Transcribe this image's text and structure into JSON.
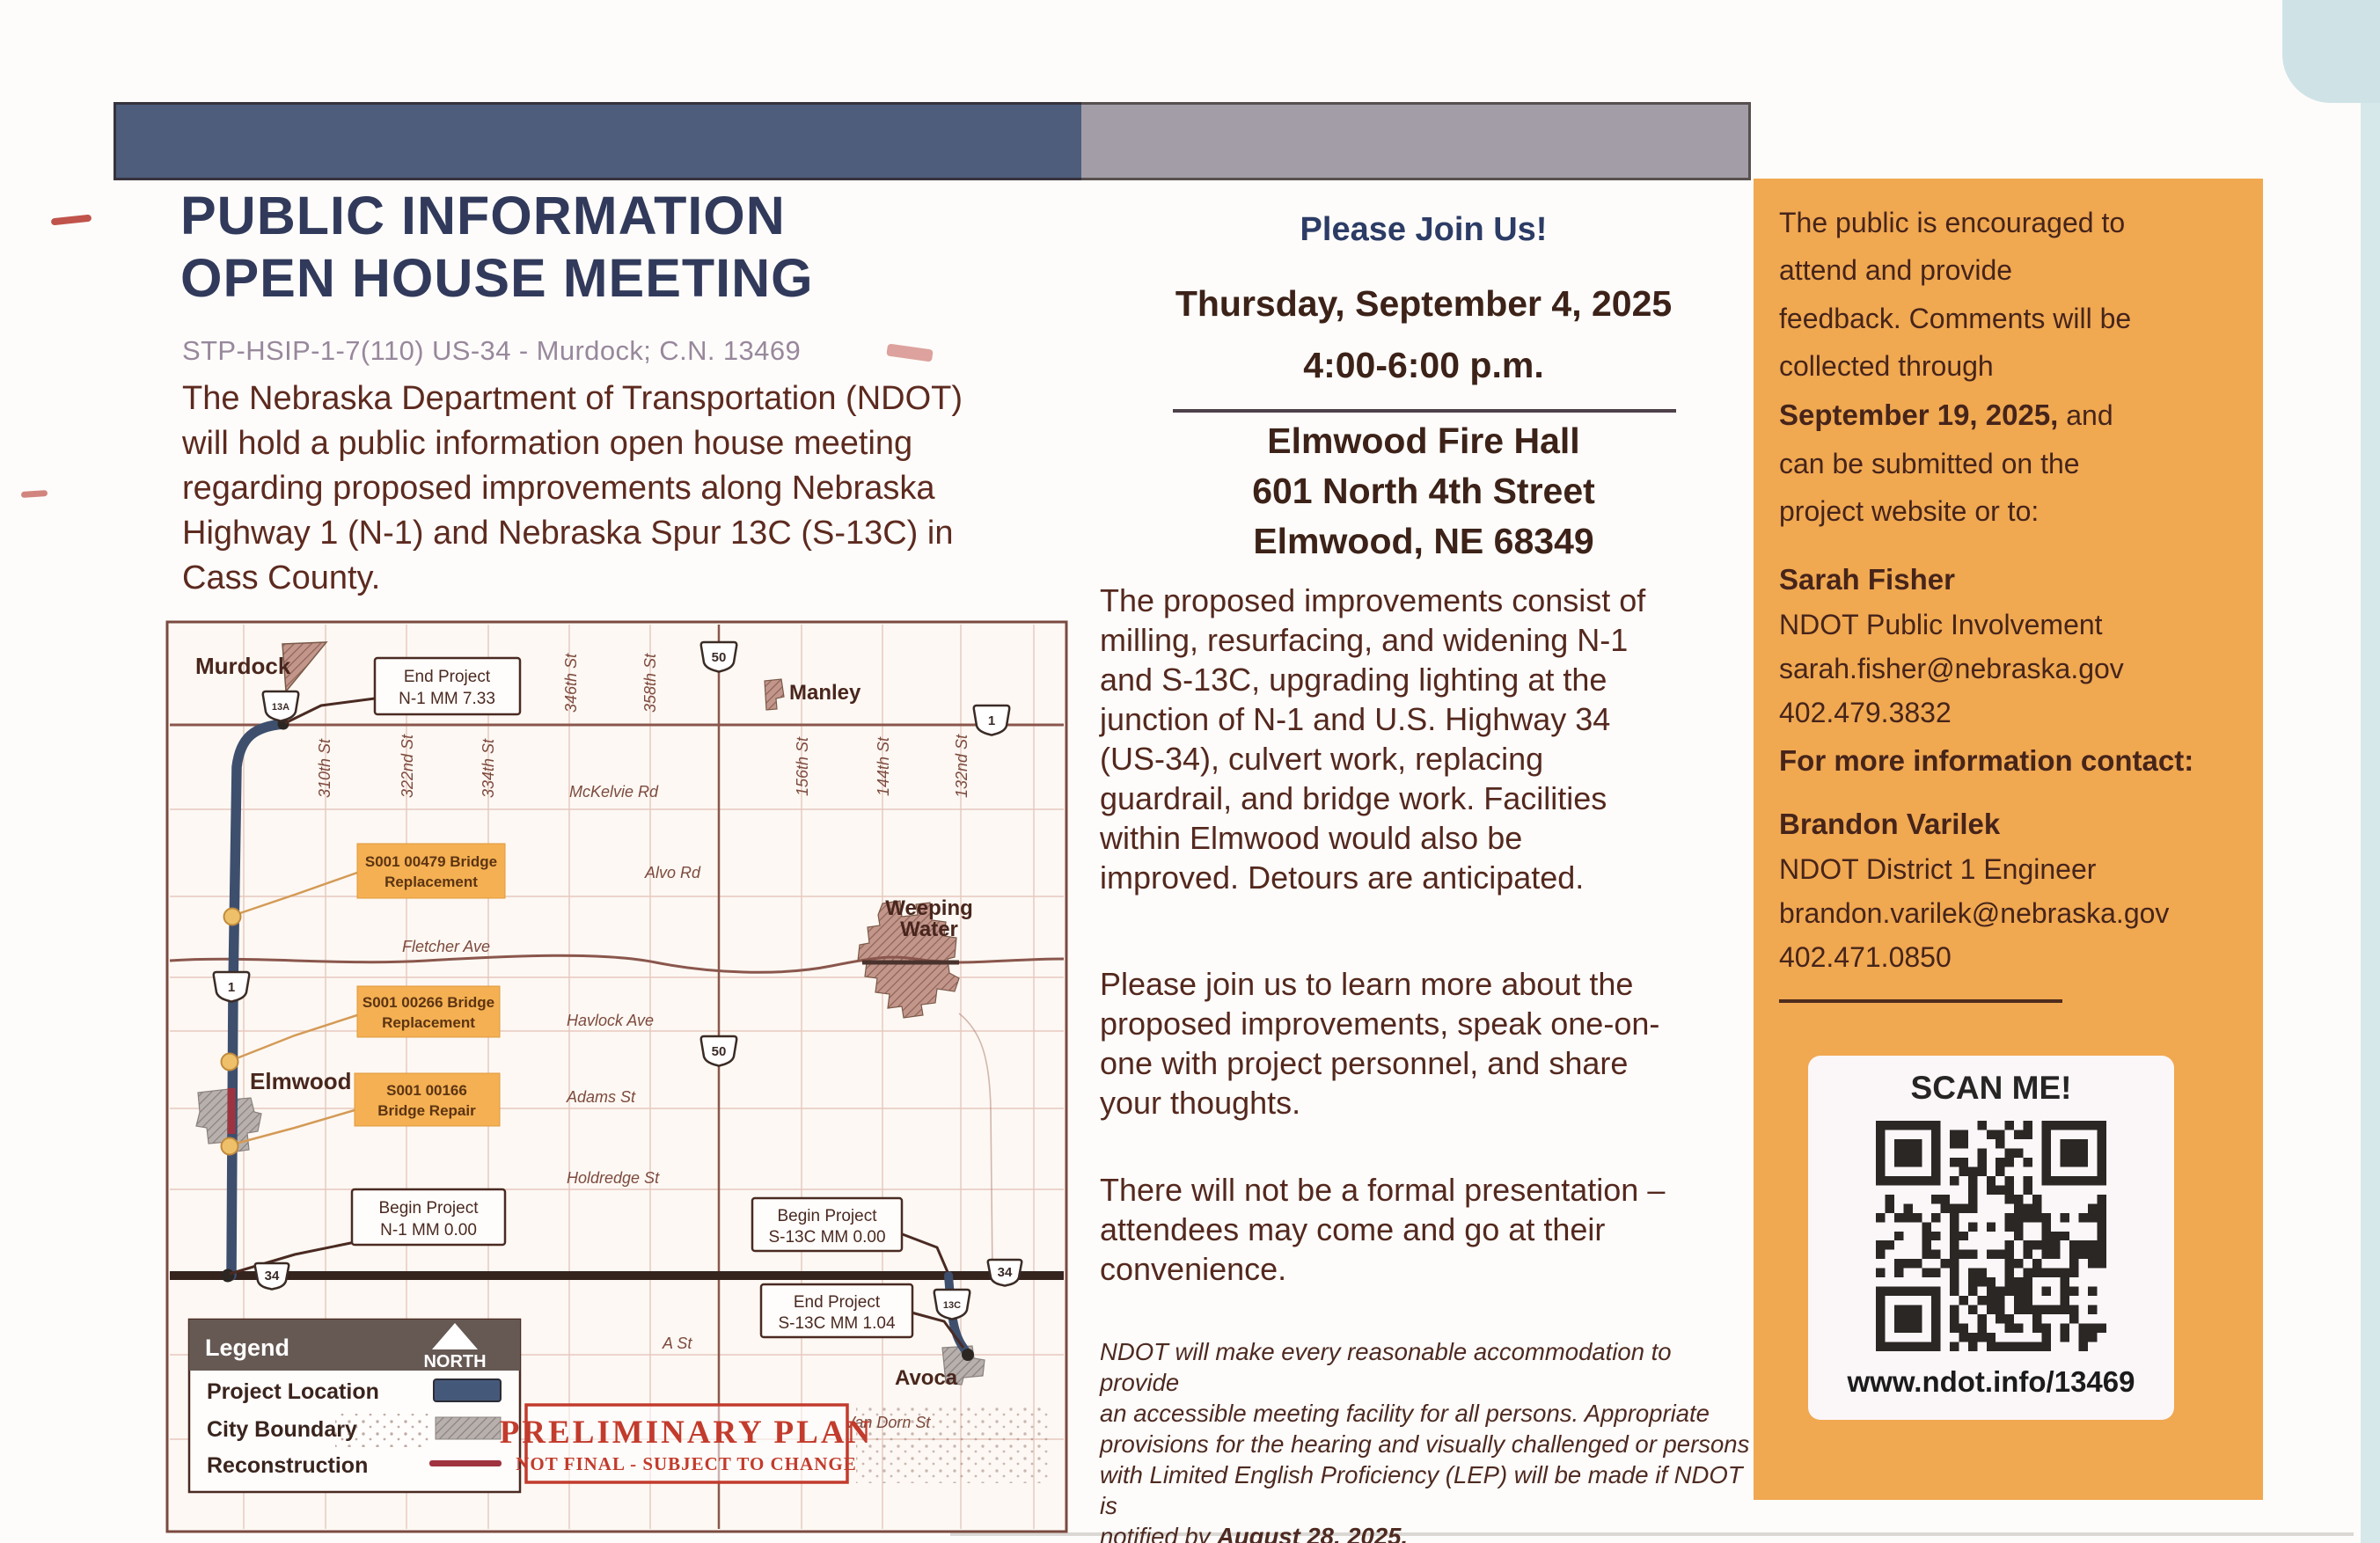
{
  "colors": {
    "bar_navy": "#4d5d7b",
    "bar_gray": "#a39da7",
    "panel_orange": "#f0a851",
    "title_navy": "#313a5b",
    "subtitle_mauve": "#98889c",
    "body_maroon": "#5d2a1f",
    "callout_orange": "#f4b052",
    "route_navy": "#3e4f6e",
    "reconstruction_red": "#9e3340",
    "stamp_red": "#c23b2c",
    "legend_header": "#665954"
  },
  "header": {
    "title_line1": "PUBLIC INFORMATION",
    "title_line2": "OPEN HOUSE MEETING",
    "subtitle": "STP-HSIP-1-7(110) US-34 - Murdock; C.N. 13469",
    "intro": "The Nebraska Department of Transportation (NDOT)\nwill hold a public information open house meeting\nregarding proposed improvements along Nebraska\nHighway 1 (N-1) and Nebraska Spur 13C (S-13C) in\nCass County."
  },
  "meeting": {
    "join": "Please Join Us!",
    "date": "Thursday, September 4, 2025",
    "time": "4:00-6:00 p.m.",
    "venue": "Elmwood Fire Hall",
    "address": "601 North 4th Street",
    "city": "Elmwood, NE 68349",
    "p1": "The proposed improvements consist of\nmilling, resurfacing, and widening N-1\nand S-13C, upgrading lighting at the\njunction of N-1 and U.S. Highway 34\n(US-34), culvert work, replacing\nguardrail, and bridge work. Facilities\nwithin Elmwood would also be\nimproved. Detours are anticipated.",
    "p2": "Please join us to learn more about the\nproposed improvements, speak one-on-\none with project personnel, and share\nyour thoughts.",
    "p3": "There will not be a formal presentation –\nattendees may come and go at their\nconvenience.",
    "disclaimer_pre": "NDOT will make every reasonable accommodation to provide\nan accessible meeting facility for all persons. Appropriate\nprovisions for the hearing and visually challenged or persons\nwith Limited English Proficiency (LEP) will be made if NDOT is\nnotified by ",
    "disclaimer_bold": "August 28, 2025."
  },
  "feedback": {
    "intro_pre": "The public is encouraged to\nattend and provide\nfeedback. Comments will be\ncollected through\n",
    "intro_bold": "September 19, 2025,",
    "intro_post": " and\ncan be submitted on the\nproject website or to:",
    "contact1": {
      "name": "Sarah Fisher",
      "role": "NDOT Public Involvement",
      "email": "sarah.fisher@nebraska.gov",
      "phone": "402.479.3832"
    },
    "more_info": "For more information contact:",
    "contact2": {
      "name": "Brandon Varilek",
      "role": "NDOT District 1 Engineer",
      "email": "brandon.varilek@nebraska.gov",
      "phone": "402.471.0850"
    },
    "scan": {
      "label": "SCAN ME!",
      "url": "www.ndot.info/13469"
    }
  },
  "map": {
    "towns": {
      "murdock": "Murdock",
      "manley": "Manley",
      "weeping1": "Weeping",
      "weeping2": "Water",
      "elmwood": "Elmwood",
      "avoca": "Avoca"
    },
    "streets": {
      "s310": "310th St",
      "s322": "322nd St",
      "s334": "334th St",
      "s346": "346th St",
      "s358": "358th St",
      "s156": "156th St",
      "s144": "144th St",
      "s132": "132nd St",
      "mckelvie": "McKelvie Rd",
      "alvo": "Alvo Rd",
      "fletcher": "Fletcher Ave",
      "havlock": "Havlock Ave",
      "adams": "Adams St",
      "holdredge": "Holdredge St",
      "a_st": "A St",
      "vandorn": "Van Dorn St"
    },
    "markers": {
      "m13a": "13A",
      "m50_top": "50",
      "m50_mid": "50",
      "m1_east": "1",
      "m1_route": "1",
      "m34_west": "34",
      "m34_east": "34",
      "m13c": "13C"
    },
    "callouts": {
      "end_n1_l1": "End Project",
      "end_n1_l2": "N-1 MM 7.33",
      "begin_n1_l1": "Begin Project",
      "begin_n1_l2": "N-1 MM 0.00",
      "begin_s13c_l1": "Begin Project",
      "begin_s13c_l2": "S-13C MM 0.00",
      "end_s13c_l1": "End Project",
      "end_s13c_l2": "S-13C MM 1.04"
    },
    "bridges": {
      "b479_l1": "S001 00479 Bridge",
      "b479_l2": "Replacement",
      "b266_l1": "S001 00266 Bridge",
      "b266_l2": "Replacement",
      "b166_l1": "S001 00166",
      "b166_l2": "Bridge Repair"
    },
    "legend": {
      "title": "Legend",
      "north": "NORTH",
      "project_location": "Project Location",
      "city_boundary": "City Boundary",
      "reconstruction": "Reconstruction"
    },
    "stamp": {
      "l1": "PRELIMINARY PLAN",
      "l2": "NOT FINAL - SUBJECT TO CHANGE"
    }
  }
}
